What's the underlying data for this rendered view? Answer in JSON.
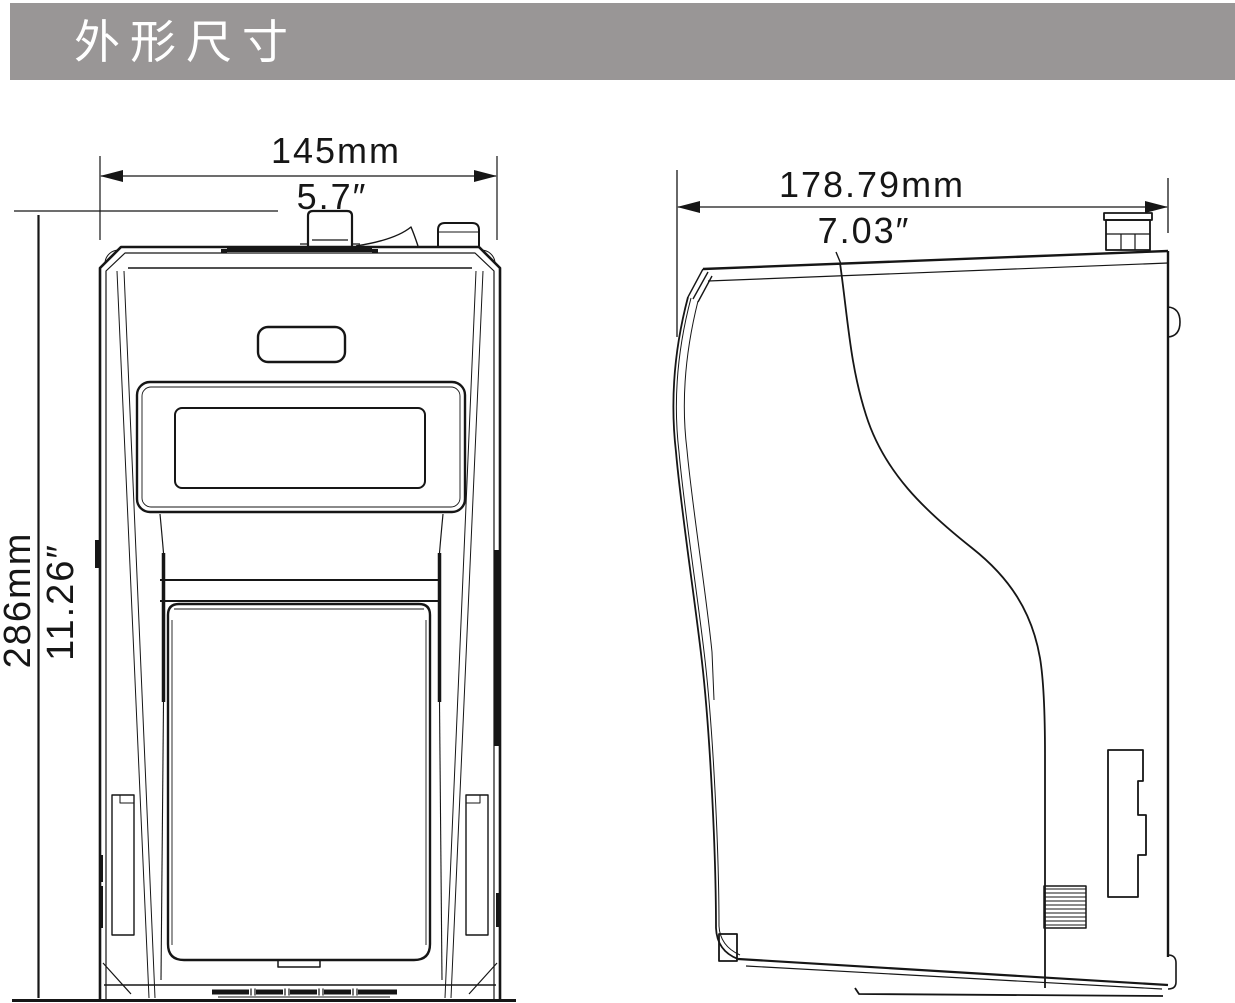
{
  "header": {
    "title": "外形尺寸"
  },
  "colors": {
    "header_bg": "#999696",
    "header_text": "#ffffff",
    "line": "#161616",
    "background": "#ffffff"
  },
  "front_view": {
    "width_mm": "145mm",
    "width_in": "5.7″",
    "height_mm": "286mm",
    "height_in": "11.26″"
  },
  "side_view": {
    "depth_mm": "178.79mm",
    "depth_in": "7.03″"
  }
}
